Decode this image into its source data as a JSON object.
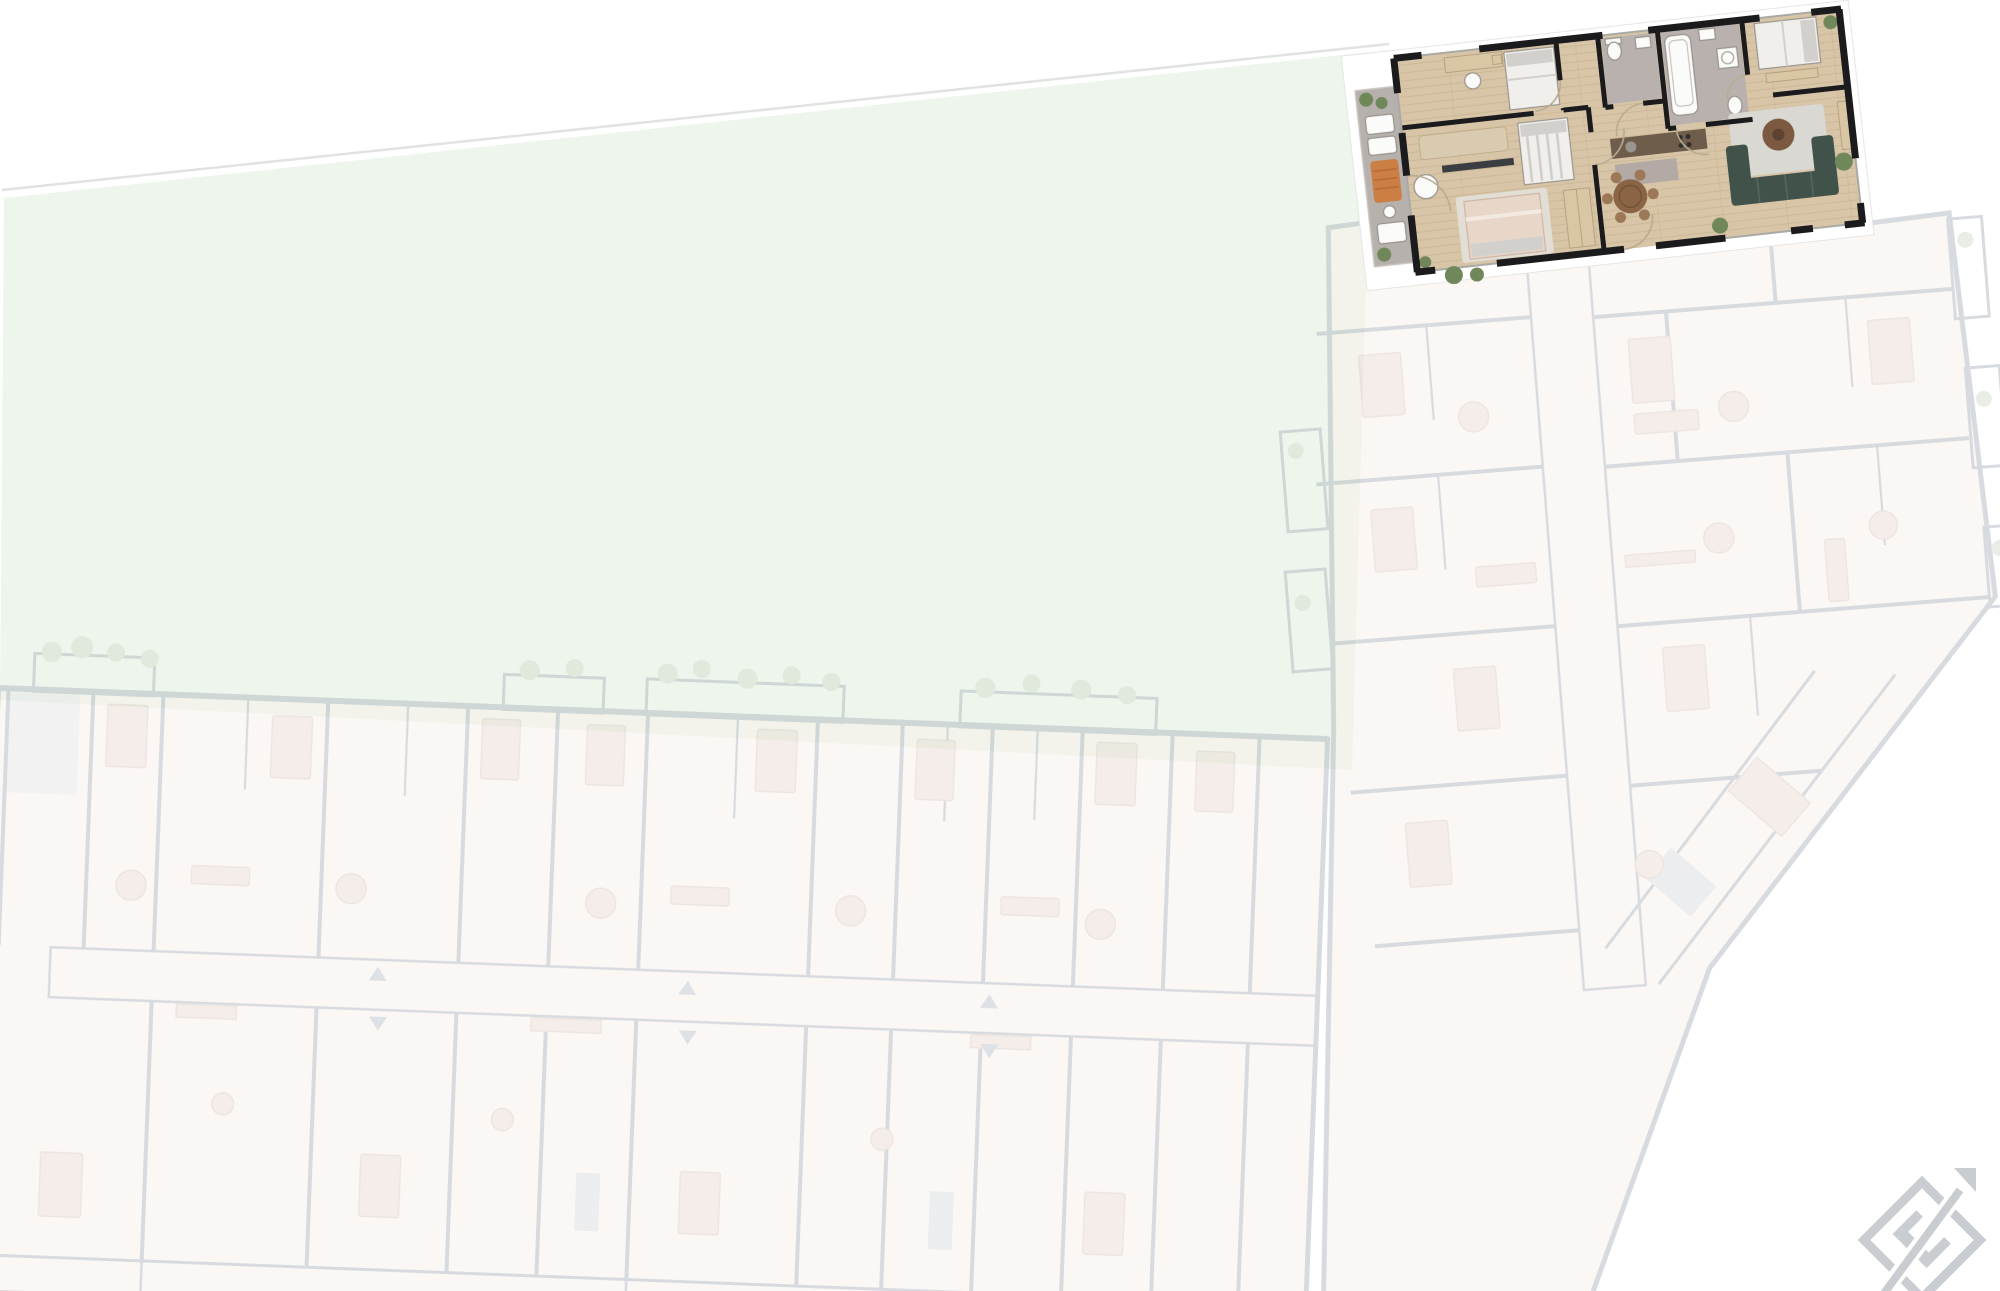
{
  "scene": {
    "type": "residential floor-plan site overview",
    "background": "#ffffff",
    "description": "Whole-building floor plan shown washed out, with one apartment unit rendered in full colour at the top right and a lawn courtyard filling the upper left"
  },
  "garden": {
    "name": "courtyard-lawn"
  },
  "faded_building": {
    "style": "inactive washed-out units",
    "wings": [
      {
        "id": "lower-wing",
        "orientation": "horizontal strip along bottom"
      },
      {
        "id": "right-wing",
        "orientation": "angled wing on right with diagonal corner"
      }
    ]
  },
  "highlighted_unit": {
    "state": "selected",
    "rooms": [
      "balcony",
      "bedroom-west",
      "bedroom-south",
      "bathroom-small",
      "bathroom-large",
      "hallway",
      "kitchen-dining",
      "bedroom-east",
      "living-room"
    ],
    "furniture": [
      "desk",
      "double-beds",
      "wardrobe",
      "beige-sofa",
      "tv-console",
      "bathtub",
      "toilet",
      "washing-machine",
      "kitchen-counter",
      "round-dining-table",
      "dining-chairs",
      "green-corner-sofa",
      "rug",
      "round-coffee-table",
      "sun-lounger",
      "potted-plants"
    ]
  },
  "compass": {
    "letter": "E",
    "arrow_direction": "up-right"
  },
  "palette": {
    "background": "#ffffff",
    "garden": "#edf5ec",
    "garden_edge": "#e0e4e0",
    "wood_floor": "#d8c5a7",
    "wood_plank_line": "#cbb694",
    "wall_black": "#1b1b1d",
    "balcony_tile": "#b6b1ac",
    "bathroom_floor": "#b9b1ad",
    "kitchen_counter": "#6f5d4b",
    "kitchen_island": "#b3a9a5",
    "bed_linen": "#f1efec",
    "pillow_grey": "#d2d0cd",
    "sofa_beige": "#d9cbb0",
    "bed_blush": "#e8d6c9",
    "furniture_tan": "#d9c6a4",
    "tv_dark": "#3a3d41",
    "sofa_green": "#41524a",
    "sofa_green_line": "#55685e",
    "rug_grey": "#d9d8d3",
    "coffee_table": "#7c5a42",
    "dining_table": "#8a6444",
    "dining_chair": "#9c7856",
    "lounger_orange": "#cc7f44",
    "plant_green": "#70875a",
    "white_fixture": "#fbfbfa",
    "fixture_line": "#9a958f",
    "window_line": "#a9a9a6",
    "door_arc": "#b9aa92",
    "faded_wall": "#b7bdc5",
    "faded_room": "#f8f1ec",
    "faded_room_alt": "#f3f1ee",
    "faded_grey": "#e7e8ea",
    "faded_furniture": "#ecdfd8",
    "faded_furniture_line": "#ddcfc8",
    "faded_plant": "#d5ded0",
    "faded_arrow": "#c4c9cf",
    "compass_grey": "#c9cdd1"
  }
}
